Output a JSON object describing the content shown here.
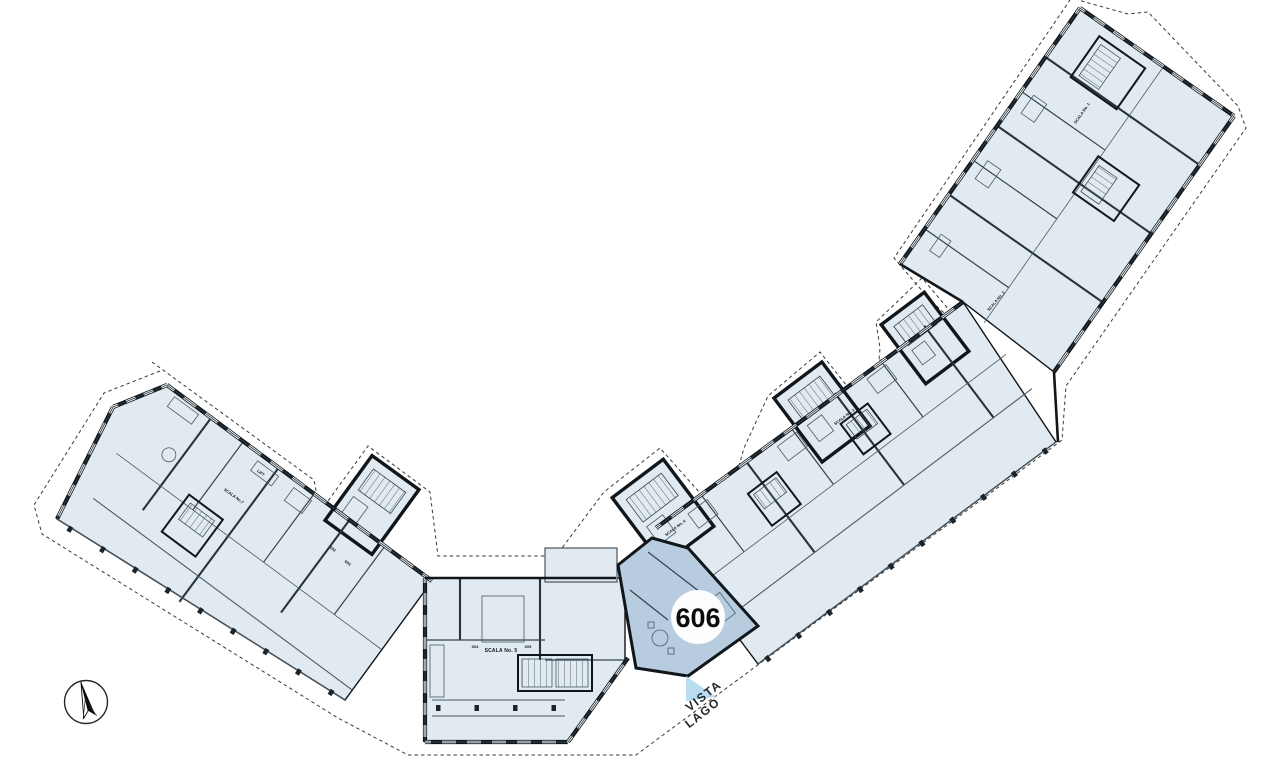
{
  "plan": {
    "highlight_unit": {
      "number": "606"
    },
    "direction_label": {
      "line1": "VISTA",
      "line2": "LAGO"
    },
    "stair_labels": {
      "s1": "SCALA No. 1",
      "s2": "SCALA No. 2",
      "s3": "SCALA No. 3",
      "s4": "SCALA No. 4",
      "s5": "SCALA No. 5",
      "s7": "SCALA No.7"
    },
    "unit_labels": {
      "u602": "602",
      "u603": "603",
      "u604": "604",
      "u605": "605"
    },
    "lift_label": "LIFT",
    "colors": {
      "unit_fill": "#e1eaf0",
      "highlight_fill": "#b7cddf",
      "wall": "#10161a",
      "boundary_dash": "#3a3a3a",
      "terrace_line": "#4a5a66",
      "lake": "#b9ddf0",
      "badge_bg": "#ffffff",
      "text": "#16181a"
    },
    "icons": {
      "compass": "north-compass-icon"
    }
  }
}
